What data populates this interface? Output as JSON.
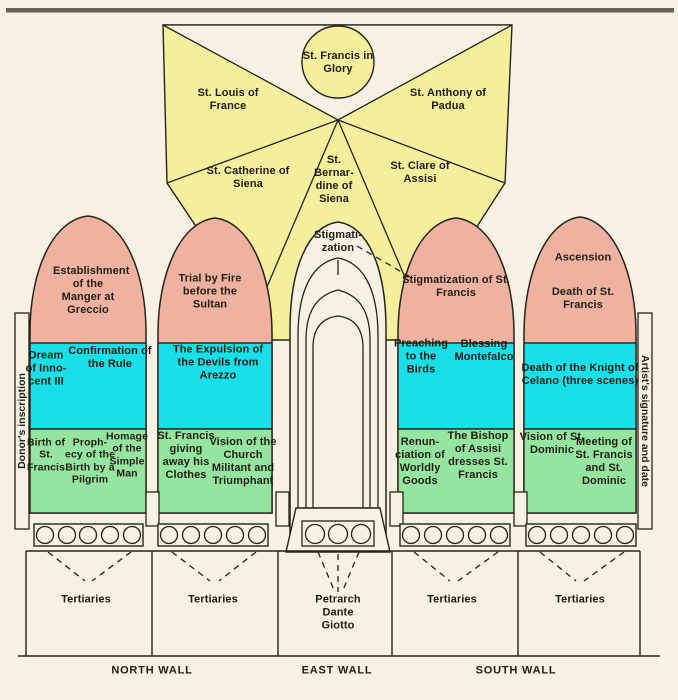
{
  "colors": {
    "background": "#f6f1e2",
    "vault_yellow": "#f4ef9d",
    "arch_pink": "#f0b2a0",
    "band_cyan": "#18dfe8",
    "band_green": "#95e5a1",
    "line": "#26231a",
    "text": "#201d12",
    "border_top": "#4b4840"
  },
  "vault": {
    "glory": "St. Francis in Glory",
    "upper_left": "St. Louis of France",
    "upper_right": "St. Anthony of Padua",
    "lower_left": "St. Catherine of Siena",
    "center": "St. Bernar-dine of Siena",
    "lower_right": "St. Clare of Assisi"
  },
  "window": {
    "apex": "Stigmati-zation",
    "poets": "Petrarch Dante Giotto"
  },
  "north1": {
    "lunette": "Establishment of the Manger at Greccio",
    "mid_left": "Dream of Inno-cent III",
    "mid_right": "Confirmation of the Rule",
    "low_1": "Birth of St. Francis",
    "low_2": "Proph-ecy of the Birth by a Pilgrim",
    "low_3": "Homage of the Simple Man",
    "predella": "Tertiaries"
  },
  "north2": {
    "lunette": "Trial by Fire before the Sultan",
    "mid": "The Expulsion of the Devils from Arezzo",
    "low_left": "St. Francis giving away his Clothes",
    "low_right": "Vision of the Church Militant and Triumphant",
    "predella": "Tertiaries"
  },
  "south1": {
    "lunette": "Stigmatization of St. Francis",
    "mid_left": "Preaching to the Birds",
    "mid_right": "Blessing Montefalco",
    "low_left": "Renun-ciation of Worldly Goods",
    "low_right": "The Bishop of Assisi dresses St. Francis",
    "predella": "Tertiaries"
  },
  "south2": {
    "lunette_top": "Ascension",
    "lunette_bottom": "Death of St. Francis",
    "mid": "Death of the Knight of Celano (three scenes)",
    "low_left": "Vision of St. Dominic",
    "low_right": "Meeting of St. Francis and St. Dominic",
    "predella": "Tertiaries"
  },
  "annotations": {
    "donor": "Donor's inscription",
    "artist": "Artist's signature and date"
  },
  "walls": {
    "north": "NORTH WALL",
    "east": "EAST WALL",
    "south": "SOUTH WALL"
  }
}
